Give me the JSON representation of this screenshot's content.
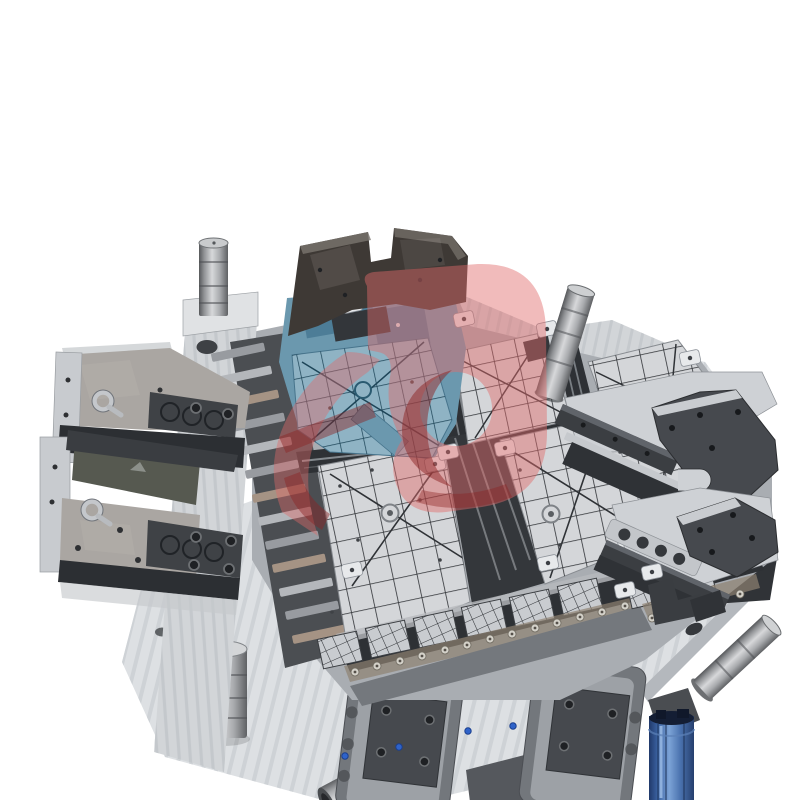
{
  "image": {
    "type": "product-photograph",
    "caption": "Large steel plastic-pallet injection mould photographed from above on a white background, with a semi-transparent red logo watermark over the centre",
    "background": "#ffffff"
  },
  "watermark": {
    "kind": "stylised red logo overlay",
    "primary": "#e06a6a",
    "accent": "#8c2424",
    "opacity": 0.46
  },
  "colors": {
    "bg": "#ffffff",
    "baseLight": "#dde0e3",
    "baseStripe": "#c9cdd1",
    "backdrop": "#a9adb2",
    "panel": "#d4d6d9",
    "gridLine": "#2f3236",
    "panelEdge": "#888c91",
    "chDark": "#2e3135",
    "blkDark": "#3b3e42",
    "pltDark": "#46494e",
    "pltEdge": "#2b2d30",
    "clamp": "#3e3935",
    "steelMid": "#9da1a6",
    "steelLight": "#ced1d5",
    "clip": "#e7e9eb",
    "wall": "#d2d5d8",
    "wallStripe": "#c2c6ca",
    "tealLight": "#8fb3c4",
    "tealMid": "#6b98ae",
    "tealDark": "#4d7d97",
    "tealGrid": "#1e4558",
    "rust": "#8e8172",
    "railGray": "#73777c",
    "railInner": "#9da1a6",
    "plateBrown": "#aaa6a2",
    "insetDark": "#3f4246",
    "sideDark": "#2c2f33",
    "blueCyl": "#3c64a4",
    "boltBlue": "#2f63c9",
    "wmRed": "#e06a6a",
    "wmDark": "#8c2424"
  },
  "objects": [
    {
      "name": "mould-base-plate",
      "label": "machined steel base plate"
    },
    {
      "name": "face-assembly",
      "label": "mould core face with pallet grid cavities"
    },
    {
      "name": "blue-core-insert",
      "label": "blue/teal core insert"
    },
    {
      "name": "top-clamp-plate",
      "label": "dark clamp plate"
    },
    {
      "name": "guide-pin-top-left",
      "label": "vertical guide pillar"
    },
    {
      "name": "guide-pin-top-right",
      "label": "angled guide pillar"
    },
    {
      "name": "guide-pin-bottom-right",
      "label": "angled guide pillar"
    },
    {
      "name": "support-pillar",
      "label": "cylindrical support pillar"
    },
    {
      "name": "ejector-rod",
      "label": "ejector rod"
    },
    {
      "name": "slider-left-upper",
      "label": "left slider block with lifting eyebolt"
    },
    {
      "name": "slider-left-lower",
      "label": "left slider block with lifting eyebolt"
    },
    {
      "name": "slider-right-upper",
      "label": "right slider with notched locking plate"
    },
    {
      "name": "slider-right-lower",
      "label": "right slider with locking plate"
    },
    {
      "name": "guide-rail-left",
      "label": "bottom guide rail unit"
    },
    {
      "name": "guide-rail-right",
      "label": "bottom guide rail unit"
    },
    {
      "name": "blue-spring-cylinder",
      "label": "blue spring / hydraulic cylinder"
    },
    {
      "name": "red-logo-watermark",
      "label": "translucent red logo watermark"
    }
  ]
}
